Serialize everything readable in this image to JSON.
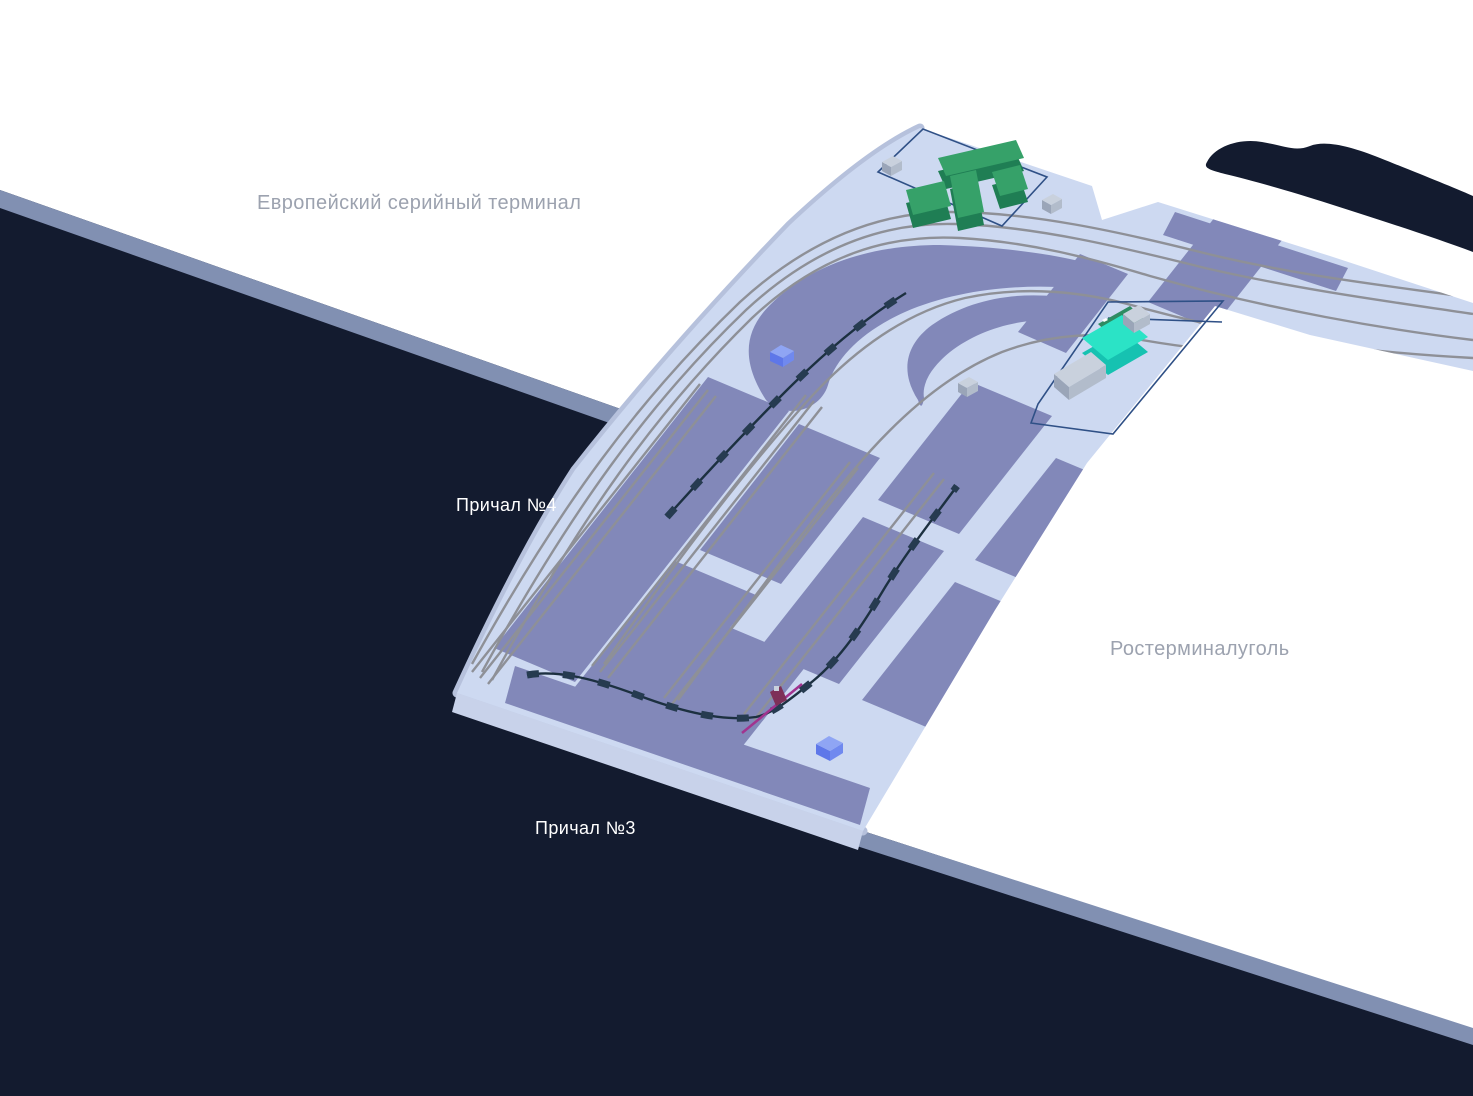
{
  "map": {
    "labels": {
      "terminal_left": "Европейский серийный терминал",
      "berth4": "Причал №4",
      "berth3": "Причал №3",
      "terminal_right": "Ростерминалуголь"
    },
    "palette": {
      "water": "#131B2F",
      "land": "#FFFFFF",
      "quay": "#8190B2",
      "platform": "#CDD9F1",
      "platform_edge": "#B6C1DC",
      "platform_side": "#C8D2EA",
      "yard": "#8288B9",
      "rail": "#8E9097",
      "train_line": "#1C3040",
      "train_wagon": "#263B50",
      "parcel_outline": "#2F5086",
      "green_roof": "#36A169",
      "green_side": "#1F7E54",
      "teal_roof": "#2BE3C6",
      "teal_side": "#16C2B1",
      "teal_back": "#2F8B62",
      "gray_top": "#C9D1DD",
      "gray_front": "#9AA5B8",
      "gray_side": "#B2BCCB",
      "marker_top": "#8FA5F4",
      "marker_front": "#5E77E9",
      "marker_side": "#7089EF",
      "crane": "#A1338F",
      "crane_box": "#7E3058",
      "label_muted": "#9CA2AF",
      "label_light": "#FFFFFF"
    }
  }
}
